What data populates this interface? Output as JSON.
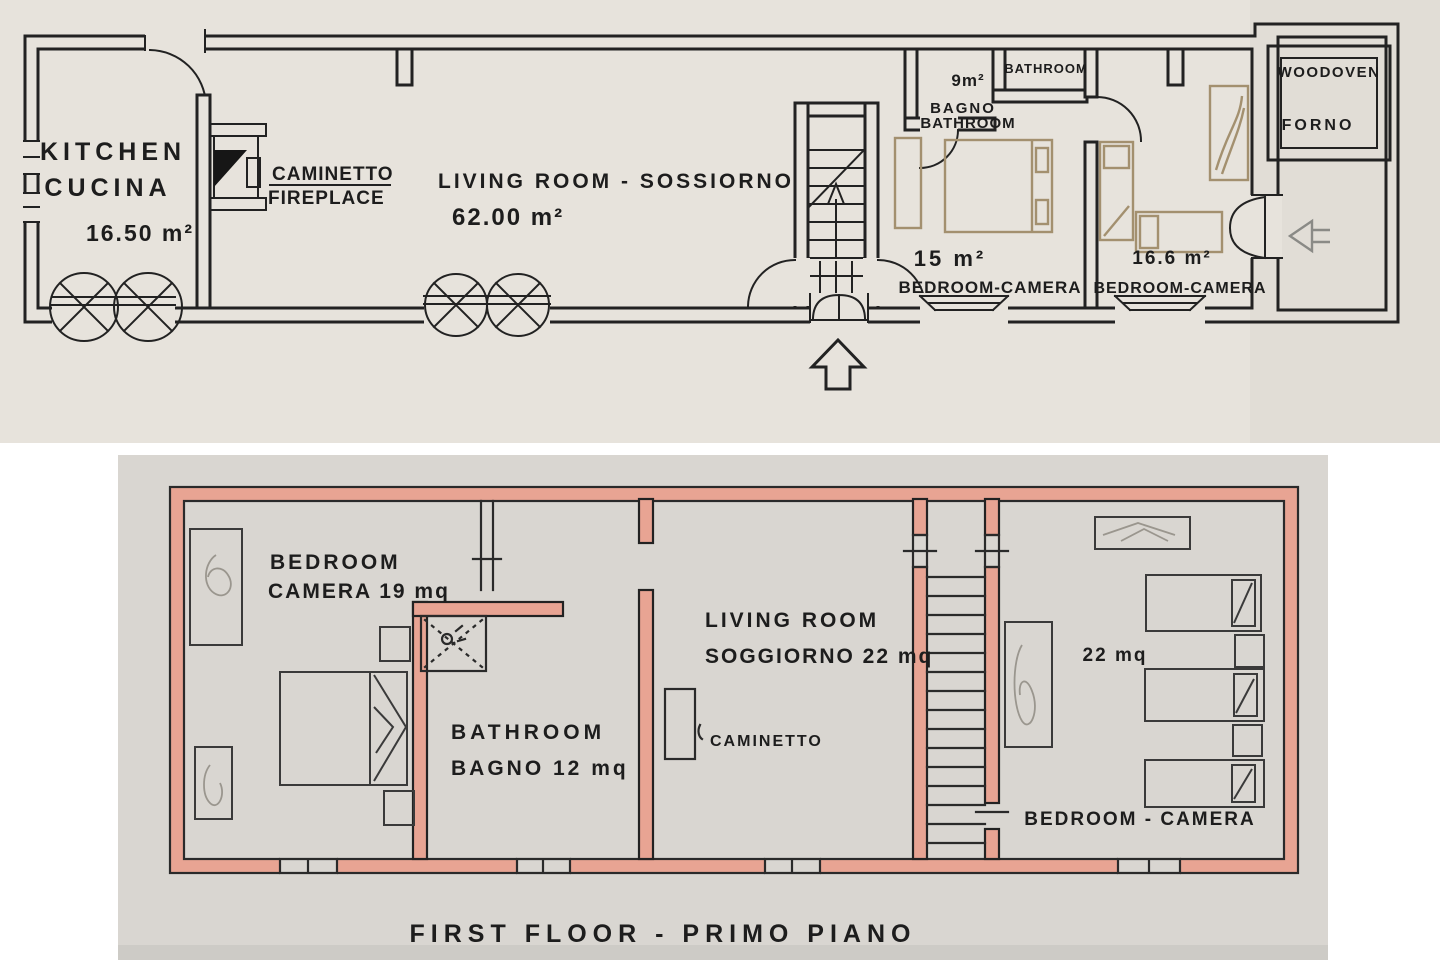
{
  "page": {
    "background": "#ffffff"
  },
  "photos": {
    "top_paper_color": "#e7e3dc",
    "bottom_paper_color": "#d9d6d1",
    "wall_highlight_color": "#e8a493"
  },
  "ground_floor": {
    "kitchen_label_en": "KITCHEN",
    "kitchen_label_it": "CUCINA",
    "kitchen_area": "16.50 m²",
    "fireplace_label_it": "CAMINETTO",
    "fireplace_label_en": "FIREPLACE",
    "living_room_label": "LIVING ROOM - SOSSIORNO",
    "living_room_area": "62.00 m²",
    "bathroom_alcove_label": "BATHROOM",
    "bathroom_area": "9m²",
    "bathroom_label_it": "BAGNO",
    "bathroom_label_en": "BATHROOM",
    "bedroom1_area": "15 m²",
    "bedroom1_label": "BEDROOM-CAMERA",
    "bedroom2_area": "16.6 m²",
    "bedroom2_label": "BEDROOM-CAMERA",
    "woodoven_label_en": "WOODOVEN",
    "woodoven_label_it": "FORNO"
  },
  "first_floor": {
    "bedroom_left_line1": "BEDROOM",
    "bedroom_left_line2": "CAMERA 19 mq",
    "bathroom_line1": "BATHROOM",
    "bathroom_line2": "BAGNO 12 mq",
    "living_line1": "LIVING ROOM",
    "living_line2": "SOGGIORNO 22 mq",
    "caminetto_label": "CAMINETTO",
    "bedroom_right_area": "22 mq",
    "bedroom_right_label": "BEDROOM - CAMERA",
    "title": "FIRST FLOOR - PRIMO PIANO"
  }
}
